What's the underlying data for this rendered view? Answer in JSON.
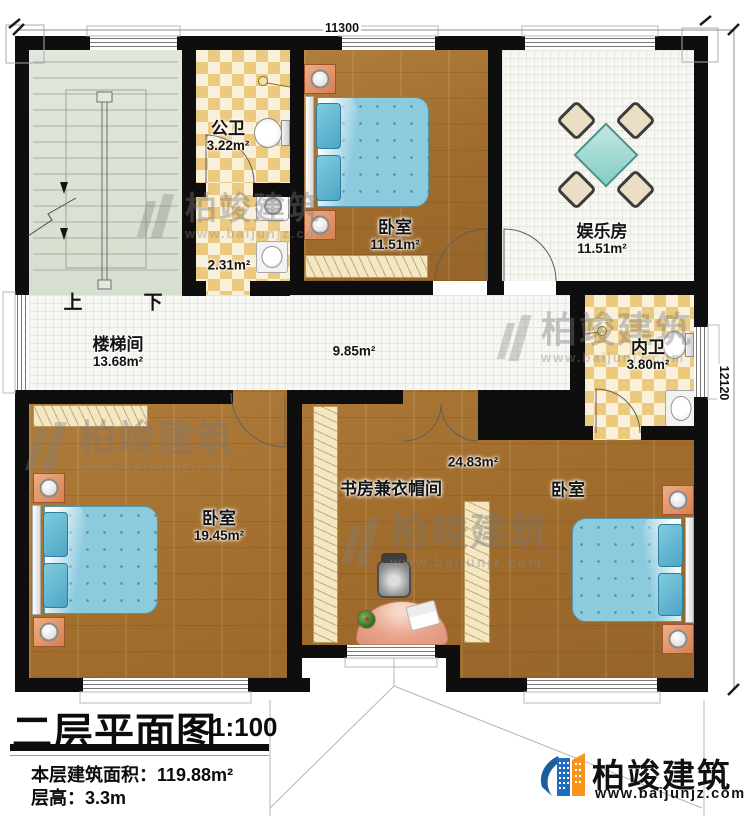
{
  "plan": {
    "dimensions": {
      "top": "11300",
      "right": "12120"
    },
    "stair": {
      "up": "上",
      "down": "下"
    },
    "rooms": [
      {
        "id": "public-bath",
        "name": "公卫",
        "area": "3.22m²"
      },
      {
        "id": "bath-anteroom",
        "name": "",
        "area": "2.31m²"
      },
      {
        "id": "bedroom-top",
        "name": "卧室",
        "area": "11.51m²"
      },
      {
        "id": "entertainment",
        "name": "娱乐房",
        "area": "11.51m²"
      },
      {
        "id": "stairwell",
        "name": "楼梯间",
        "area": "13.68m²"
      },
      {
        "id": "hallway",
        "name": "",
        "area": "9.85m²"
      },
      {
        "id": "ensuite-bath",
        "name": "内卫",
        "area": "3.80m²"
      },
      {
        "id": "bedroom-left",
        "name": "卧室",
        "area": "19.45m²"
      },
      {
        "id": "study-cloakroom",
        "name": "书房兼衣帽间",
        "area": "24.83m²"
      },
      {
        "id": "bedroom-right",
        "name": "卧室",
        "area": ""
      }
    ]
  },
  "title_block": {
    "title": "二层平面图",
    "scale": "1:100",
    "floor_area": "本层建筑面积：119.88m²",
    "floor_height": "层高：3.3m"
  },
  "brand": {
    "name": "柏竣建筑",
    "url": "www.baijunjz.com"
  },
  "watermark": {
    "name": "柏竣建筑",
    "url": "www.baijunjz.com"
  },
  "colors": {
    "wall": "#0e0e0e",
    "wood_floor": "#a6732f",
    "tile_checker": "#ebc97e",
    "bed_blanket": "#8ccade",
    "game_table": "#9fd9d4",
    "desk": "#e8a58c",
    "brand_blue": "#1b5e9e",
    "brand_orange": "#f7941d"
  }
}
